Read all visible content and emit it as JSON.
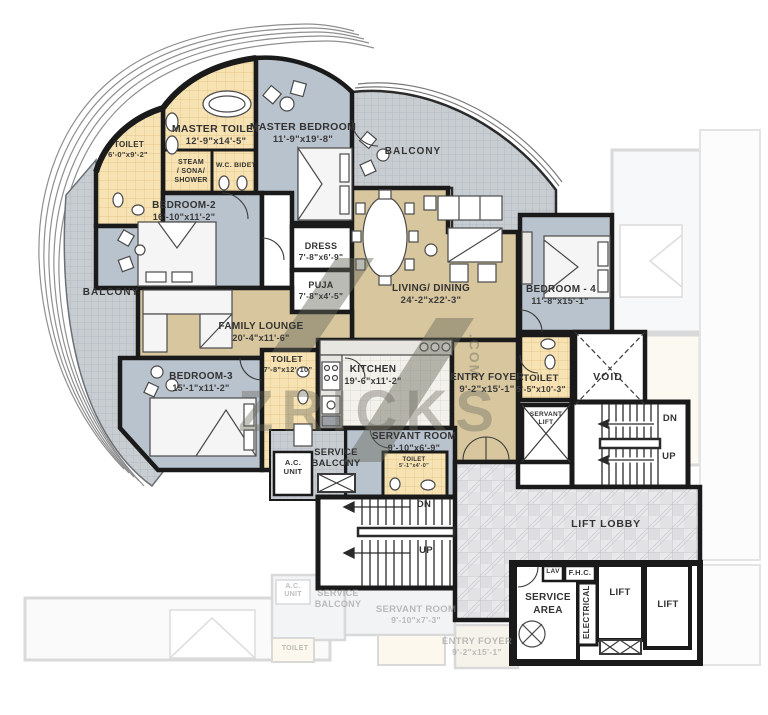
{
  "watermark": {
    "brand": "ZRICKS",
    "suffix": ".COM"
  },
  "rooms": {
    "toilet_tl": {
      "name": "TOILET",
      "dims": "6'-0\"x9'-2\""
    },
    "master_toilet": {
      "name": "MASTER TOILET",
      "dims": "12'-9\"x14'-5\""
    },
    "steam": {
      "line1": "STEAM",
      "line2": "/ SONA/",
      "line3": "SHOWER"
    },
    "wc_bidet": {
      "name": "W.C. BIDET"
    },
    "master_bedroom": {
      "name": "MASTER BEDROOM",
      "dims": "11'-9\"x19'-8\""
    },
    "balcony_top": {
      "name": "BALCONY"
    },
    "balcony_left": {
      "name": "BALCONY"
    },
    "bedroom2": {
      "name": "BEDROOM-2",
      "dims": "16'-10\"x11'-2\""
    },
    "dress": {
      "name": "DRESS",
      "dims": "7'-8\"x6'-9\""
    },
    "puja": {
      "name": "PUJA",
      "dims": "7'-8\"x4'-5\""
    },
    "living": {
      "name": "LIVING/ DINING",
      "dims": "24'-2\"x22'-3\""
    },
    "family": {
      "name": "FAMILY LOUNGE",
      "dims": "20'-4\"x11'-6\""
    },
    "bedroom3": {
      "name": "BEDROOM-3",
      "dims": "15'-1\"x11'-2\""
    },
    "toilet3": {
      "name": "TOILET",
      "dims": "7'-8\"x12'-10\""
    },
    "kitchen": {
      "name": "KITCHEN",
      "dims": "19'-6\"x11'-2\""
    },
    "entry": {
      "name": "ENTRY FOYER",
      "dims": "9'-2\"x15'-1\""
    },
    "servant": {
      "name": "SERVANT ROOM",
      "dims": "9'-10\"x6'-9\""
    },
    "toilet_srv": {
      "name": "TOILET",
      "dims": "5'-1\"x4'-0\""
    },
    "service_balcony": {
      "line1": "SERVICE",
      "line2": "BALCONY"
    },
    "ac_unit": {
      "line1": "A.C.",
      "line2": "UNIT"
    },
    "bedroom4": {
      "name": "BEDROOM - 4",
      "dims": "11'-8\"x15'-1\""
    },
    "toilet4": {
      "name": "TOILET",
      "dims": "5'-5\"x10'-3\""
    },
    "void": {
      "name": "VOID"
    },
    "servant_lift": {
      "line1": "SERVANT",
      "line2": "LIFT"
    },
    "stairs_mid": {
      "dn": "DN",
      "up": "UP"
    },
    "stairs_right": {
      "dn": "DN",
      "up": "UP"
    },
    "lift_lobby": {
      "name": "LIFT LOBBY"
    },
    "service_area": {
      "line1": "SERVICE",
      "line2": "AREA"
    },
    "lav": {
      "name": "LAV"
    },
    "fhc": {
      "name": "F.H.C."
    },
    "electrical": {
      "name": "ELECTRICAL"
    },
    "lift1": {
      "name": "LIFT"
    },
    "lift2": {
      "name": "LIFT"
    }
  },
  "ghost": {
    "ac1": "A.C.",
    "ac2": "UNIT",
    "sb1": "SERVICE",
    "sb2": "BALCONY",
    "servant_room": "SERVANT ROOM",
    "servant_dims": "9'-10\"x7'-3\"",
    "toilet": "TOILET",
    "entry": "ENTRY FOYER",
    "entry_dims": "9'-2\"x15'-1\""
  },
  "colors": {
    "bedroom_fill": "#b9c3cd",
    "toilet_fill": "#f6e2b3",
    "living_fill": "#d8c79e",
    "balcony_fill": "#c8cdd2",
    "wall": "#1a1a1a",
    "marble": "#e9e9eb"
  }
}
